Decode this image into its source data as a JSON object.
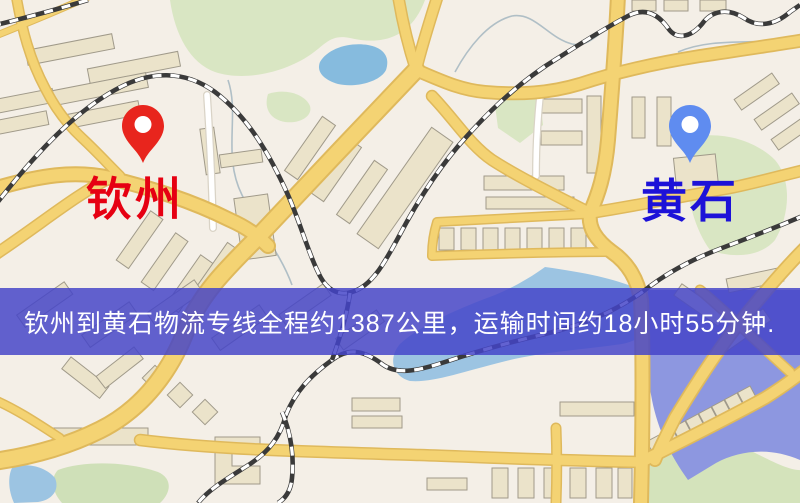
{
  "map": {
    "origin": {
      "label": "钦州",
      "label_color": "#e60012",
      "pin_color": "#e8251d"
    },
    "destination": {
      "label": "黄石",
      "label_color": "#1d12d8",
      "pin_color": "#5f8cf0"
    },
    "banner": {
      "text": "钦州到黄石物流专线全程约1387公里，运输时间约18小时55分钟.",
      "bg_color": "#4444c8",
      "text_color": "#ffffff"
    },
    "palette": {
      "background": "#f4efe7",
      "road_fill": "#f4d373",
      "road_casing": "#dfb95c",
      "park_green": "#d9e6c3",
      "water_blue": "#9cc4e2",
      "water_violet": "#8d97e0",
      "building": "#ebe3ca",
      "railway": "#3a3a3a"
    }
  }
}
